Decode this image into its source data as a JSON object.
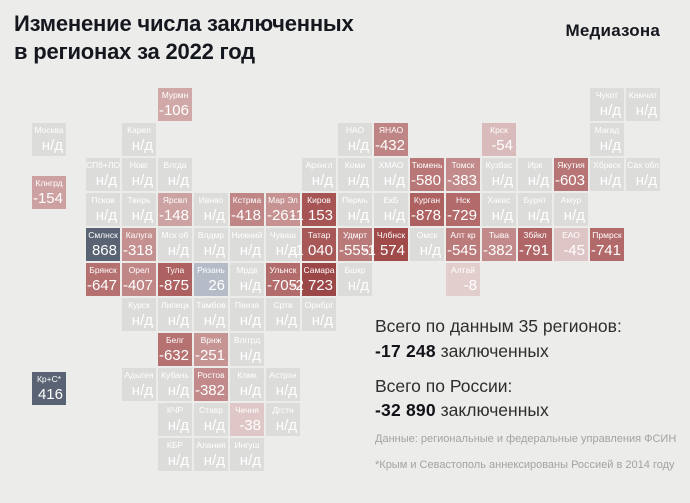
{
  "header": {
    "title": "Изменение числа заключенных\nв регионах за 2022 год",
    "logo": "Медиазона"
  },
  "summary": {
    "blocks": [
      {
        "label": "Всего по данным 35 регионов:",
        "value": "-17 248",
        "suffix": " заключенных"
      },
      {
        "label": "Всего по России:",
        "value": "-32 890",
        "suffix": " заключенных"
      }
    ],
    "source": "Данные: региональные и федеральные управления ФСИН",
    "footnote": "*Крым и Севастополь аннексированы Россией в 2014 году"
  },
  "colors": {
    "background": "#ececea",
    "no_data_tile": "#dcdcdb",
    "positive_dark": "#5a6373",
    "positive_light": "#b5bcc7",
    "tile_text": "#ffffff",
    "text_dark": "#15171e",
    "muted_text": "#a3a3a2"
  },
  "chart_data": {
    "type": "heatmap",
    "subtype": "tile-grid-cartogram",
    "title": "Изменение числа заключенных в регионах за 2022 год",
    "no_data_label": "н/д",
    "total_reported_regions": 35,
    "total_reported_change": -17248,
    "total_russia_change": -32890,
    "tiles": [
      {
        "label": "Мурмн",
        "value": -106,
        "display": "-106",
        "r": 0,
        "c": 2,
        "color": "#d1a8a8"
      },
      {
        "label": "Чукот",
        "value": null,
        "display": "н/д",
        "r": 0,
        "c": 14,
        "color": "#dcdcdb"
      },
      {
        "label": "Камчат",
        "value": null,
        "display": "н/д",
        "r": 0,
        "c": 15,
        "color": "#dcdcdb"
      },
      {
        "label": "Москва",
        "value": null,
        "display": "н/д",
        "r": 1,
        "c": -1.5,
        "color": "#dcdcdb"
      },
      {
        "label": "Карел",
        "value": null,
        "display": "н/д",
        "r": 1,
        "c": 1,
        "color": "#dcdcdb"
      },
      {
        "label": "НАО",
        "value": null,
        "display": "н/д",
        "r": 1,
        "c": 7,
        "color": "#dcdcdb"
      },
      {
        "label": "ЯНАО",
        "value": -432,
        "display": "-432",
        "r": 1,
        "c": 8,
        "color": "#bf8484"
      },
      {
        "label": "Крск",
        "value": -54,
        "display": "-54",
        "r": 1,
        "c": 11,
        "color": "#dabbbb"
      },
      {
        "label": "Магад",
        "value": null,
        "display": "н/д",
        "r": 1,
        "c": 14,
        "color": "#dcdcdb"
      },
      {
        "label": "СПб+ЛО",
        "value": null,
        "display": "н/д",
        "r": 2,
        "c": 0,
        "color": "#dcdcdb"
      },
      {
        "label": "Новг",
        "value": null,
        "display": "н/д",
        "r": 2,
        "c": 1,
        "color": "#dcdcdb"
      },
      {
        "label": "Влгда",
        "value": null,
        "display": "н/д",
        "r": 2,
        "c": 2,
        "color": "#dcdcdb"
      },
      {
        "label": "Архнгл",
        "value": null,
        "display": "н/д",
        "r": 2,
        "c": 6,
        "color": "#dcdcdb"
      },
      {
        "label": "Коми",
        "value": null,
        "display": "н/д",
        "r": 2,
        "c": 7,
        "color": "#dcdcdb"
      },
      {
        "label": "ХМАО",
        "value": null,
        "display": "н/д",
        "r": 2,
        "c": 8,
        "color": "#dcdcdb"
      },
      {
        "label": "Тюмень",
        "value": -580,
        "display": "-580",
        "r": 2,
        "c": 9,
        "color": "#b97777"
      },
      {
        "label": "Томск",
        "value": -383,
        "display": "-383",
        "r": 2,
        "c": 10,
        "color": "#c28a8a"
      },
      {
        "label": "Кузбас",
        "value": null,
        "display": "н/д",
        "r": 2,
        "c": 11,
        "color": "#dcdcdb"
      },
      {
        "label": "Ирк",
        "value": null,
        "display": "н/д",
        "r": 2,
        "c": 12,
        "color": "#dcdcdb"
      },
      {
        "label": "Якутия",
        "value": -603,
        "display": "-603",
        "r": 2,
        "c": 13,
        "color": "#b87575"
      },
      {
        "label": "Хбрвск",
        "value": null,
        "display": "н/д",
        "r": 2,
        "c": 14,
        "color": "#dcdcdb"
      },
      {
        "label": "Сах обл",
        "value": null,
        "display": "н/д",
        "r": 2,
        "c": 15,
        "color": "#dcdcdb"
      },
      {
        "label": "Клнгрд",
        "value": -154,
        "display": "-154",
        "r": 2.5,
        "c": -1.5,
        "color": "#cda1a1"
      },
      {
        "label": "Псков",
        "value": null,
        "display": "н/д",
        "r": 3,
        "c": 0,
        "color": "#dcdcdb"
      },
      {
        "label": "Тверь",
        "value": null,
        "display": "н/д",
        "r": 3,
        "c": 1,
        "color": "#dcdcdb"
      },
      {
        "label": "Ярсвл",
        "value": -148,
        "display": "-148",
        "r": 3,
        "c": 2,
        "color": "#cda2a2"
      },
      {
        "label": "Ивнво",
        "value": null,
        "display": "н/д",
        "r": 3,
        "c": 3,
        "color": "#dcdcdb"
      },
      {
        "label": "Кстрма",
        "value": -418,
        "display": "-418",
        "r": 3,
        "c": 4,
        "color": "#c08686"
      },
      {
        "label": "Мар Эл",
        "value": -261,
        "display": "-261",
        "r": 3,
        "c": 5,
        "color": "#c69292"
      },
      {
        "label": "Киров",
        "value": -1153,
        "display": "-1 153",
        "r": 3,
        "c": 6,
        "color": "#a75454"
      },
      {
        "label": "Пермь",
        "value": null,
        "display": "н/д",
        "r": 3,
        "c": 7,
        "color": "#dcdcdb"
      },
      {
        "label": "ЕкБ",
        "value": null,
        "display": "н/д",
        "r": 3,
        "c": 8,
        "color": "#dcdcdb"
      },
      {
        "label": "Курган",
        "value": -878,
        "display": "-878",
        "r": 3,
        "c": 9,
        "color": "#ae6161"
      },
      {
        "label": "Нск",
        "value": -729,
        "display": "-729",
        "r": 3,
        "c": 10,
        "color": "#b26a6a"
      },
      {
        "label": "Хакас",
        "value": null,
        "display": "н/д",
        "r": 3,
        "c": 11,
        "color": "#dcdcdb"
      },
      {
        "label": "Бурят",
        "value": null,
        "display": "н/д",
        "r": 3,
        "c": 12,
        "color": "#dcdcdb"
      },
      {
        "label": "Амур",
        "value": null,
        "display": "н/д",
        "r": 3,
        "c": 13,
        "color": "#dcdcdb"
      },
      {
        "label": "Смлнск",
        "value": 868,
        "display": "868",
        "r": 4,
        "c": 0,
        "color": "#5a6373"
      },
      {
        "label": "Калуга",
        "value": -318,
        "display": "-318",
        "r": 4,
        "c": 1,
        "color": "#c59090"
      },
      {
        "label": "Мск об",
        "value": null,
        "display": "н/д",
        "r": 4,
        "c": 2,
        "color": "#dcdcdb"
      },
      {
        "label": "Влдмр",
        "value": null,
        "display": "н/д",
        "r": 4,
        "c": 3,
        "color": "#dcdcdb"
      },
      {
        "label": "Нижний",
        "value": null,
        "display": "н/д",
        "r": 4,
        "c": 4,
        "color": "#dcdcdb"
      },
      {
        "label": "Чуваш",
        "value": null,
        "display": "н/д",
        "r": 4,
        "c": 5,
        "color": "#dcdcdb"
      },
      {
        "label": "Татар",
        "value": -1040,
        "display": "-1 040",
        "r": 4,
        "c": 6,
        "color": "#a95858"
      },
      {
        "label": "Удмрт",
        "value": -555,
        "display": "-555",
        "r": 4,
        "c": 7,
        "color": "#ba7a7a"
      },
      {
        "label": "Члбнск",
        "value": -1574,
        "display": "-1 574",
        "r": 4,
        "c": 8,
        "color": "#a14a4a"
      },
      {
        "label": "Омск",
        "value": null,
        "display": "н/д",
        "r": 4,
        "c": 9,
        "color": "#dcdcdb"
      },
      {
        "label": "Алт кр",
        "value": -545,
        "display": "-545",
        "r": 4,
        "c": 10,
        "color": "#bb7b7b"
      },
      {
        "label": "Тыва",
        "value": -382,
        "display": "-382",
        "r": 4,
        "c": 11,
        "color": "#c28a8a"
      },
      {
        "label": "Збйкл",
        "value": -791,
        "display": "-791",
        "r": 4,
        "c": 12,
        "color": "#b06666"
      },
      {
        "label": "ЕАО",
        "value": -45,
        "display": "-45",
        "r": 4,
        "c": 13,
        "color": "#dec5c5"
      },
      {
        "label": "Прмрск",
        "value": -741,
        "display": "-741",
        "r": 4,
        "c": 14,
        "color": "#b26969"
      },
      {
        "label": "Брянск",
        "value": -647,
        "display": "-647",
        "r": 5,
        "c": 0,
        "color": "#b57070"
      },
      {
        "label": "Орел",
        "value": -407,
        "display": "-407",
        "r": 5,
        "c": 1,
        "color": "#c18787"
      },
      {
        "label": "Тула",
        "value": -875,
        "display": "-875",
        "r": 5,
        "c": 2,
        "color": "#ae6161"
      },
      {
        "label": "Рязань",
        "value": 26,
        "display": "26",
        "r": 5,
        "c": 3,
        "color": "#b5bcc7"
      },
      {
        "label": "Мрдв",
        "value": null,
        "display": "н/д",
        "r": 5,
        "c": 4,
        "color": "#dcdcdb"
      },
      {
        "label": "Ульнск",
        "value": -705,
        "display": "-705",
        "r": 5,
        "c": 5,
        "color": "#b36c6c"
      },
      {
        "label": "Самара",
        "value": -2723,
        "display": "-2 723",
        "r": 5,
        "c": 6,
        "color": "#9c4747"
      },
      {
        "label": "Бшкр",
        "value": null,
        "display": "н/д",
        "r": 5,
        "c": 7,
        "color": "#dcdcdb"
      },
      {
        "label": "Алтай",
        "value": -8,
        "display": "-8",
        "r": 5,
        "c": 10,
        "color": "#e3cece"
      },
      {
        "label": "Курск",
        "value": null,
        "display": "н/д",
        "r": 6,
        "c": 1,
        "color": "#dcdcdb"
      },
      {
        "label": "Липецк",
        "value": null,
        "display": "н/д",
        "r": 6,
        "c": 2,
        "color": "#dcdcdb"
      },
      {
        "label": "Тамбов",
        "value": null,
        "display": "н/д",
        "r": 6,
        "c": 3,
        "color": "#dcdcdb"
      },
      {
        "label": "Пенза",
        "value": null,
        "display": "н/д",
        "r": 6,
        "c": 4,
        "color": "#dcdcdb"
      },
      {
        "label": "Сртв",
        "value": null,
        "display": "н/д",
        "r": 6,
        "c": 5,
        "color": "#dcdcdb"
      },
      {
        "label": "Орнбрг",
        "value": null,
        "display": "н/д",
        "r": 6,
        "c": 6,
        "color": "#dcdcdb"
      },
      {
        "label": "Белг",
        "value": -632,
        "display": "-632",
        "r": 7,
        "c": 2,
        "color": "#b67171"
      },
      {
        "label": "Врнж",
        "value": -251,
        "display": "-251",
        "r": 7,
        "c": 3,
        "color": "#c79494"
      },
      {
        "label": "Влггрд",
        "value": null,
        "display": "н/д",
        "r": 7,
        "c": 4,
        "color": "#dcdcdb"
      },
      {
        "label": "Кр+С*",
        "value": 416,
        "display": "416",
        "r": 8.1,
        "c": -1.5,
        "color": "#5a6373"
      },
      {
        "label": "Адыгея",
        "value": null,
        "display": "н/д",
        "r": 8,
        "c": 1,
        "color": "#dcdcdb"
      },
      {
        "label": "Кубань",
        "value": null,
        "display": "н/д",
        "r": 8,
        "c": 2,
        "color": "#dcdcdb"
      },
      {
        "label": "Ростов",
        "value": -382,
        "display": "-382",
        "r": 8,
        "c": 3,
        "color": "#c28a8a"
      },
      {
        "label": "Клмк",
        "value": null,
        "display": "н/д",
        "r": 8,
        "c": 4,
        "color": "#dcdcdb"
      },
      {
        "label": "Астрхн",
        "value": null,
        "display": "н/д",
        "r": 8,
        "c": 5,
        "color": "#dcdcdb"
      },
      {
        "label": "КЧР",
        "value": null,
        "display": "н/д",
        "r": 9,
        "c": 2,
        "color": "#dcdcdb"
      },
      {
        "label": "Ставр",
        "value": null,
        "display": "н/д",
        "r": 9,
        "c": 3,
        "color": "#dcdcdb"
      },
      {
        "label": "Чечня",
        "value": -38,
        "display": "-38",
        "r": 9,
        "c": 4,
        "color": "#dfc7c7"
      },
      {
        "label": "Дгстн",
        "value": null,
        "display": "н/д",
        "r": 9,
        "c": 5,
        "color": "#dcdcdb"
      },
      {
        "label": "КБР",
        "value": null,
        "display": "н/д",
        "r": 10,
        "c": 2,
        "color": "#dcdcdb"
      },
      {
        "label": "Алания",
        "value": null,
        "display": "н/д",
        "r": 10,
        "c": 3,
        "color": "#dcdcdb"
      },
      {
        "label": "Ингуш",
        "value": null,
        "display": "н/д",
        "r": 10,
        "c": 4,
        "color": "#dcdcdb"
      }
    ],
    "layout": {
      "grid_origin_x": 86,
      "grid_origin_y": 88,
      "col_pitch": 36,
      "row_pitch": 35,
      "tile_w": 34,
      "tile_h": 33
    }
  }
}
